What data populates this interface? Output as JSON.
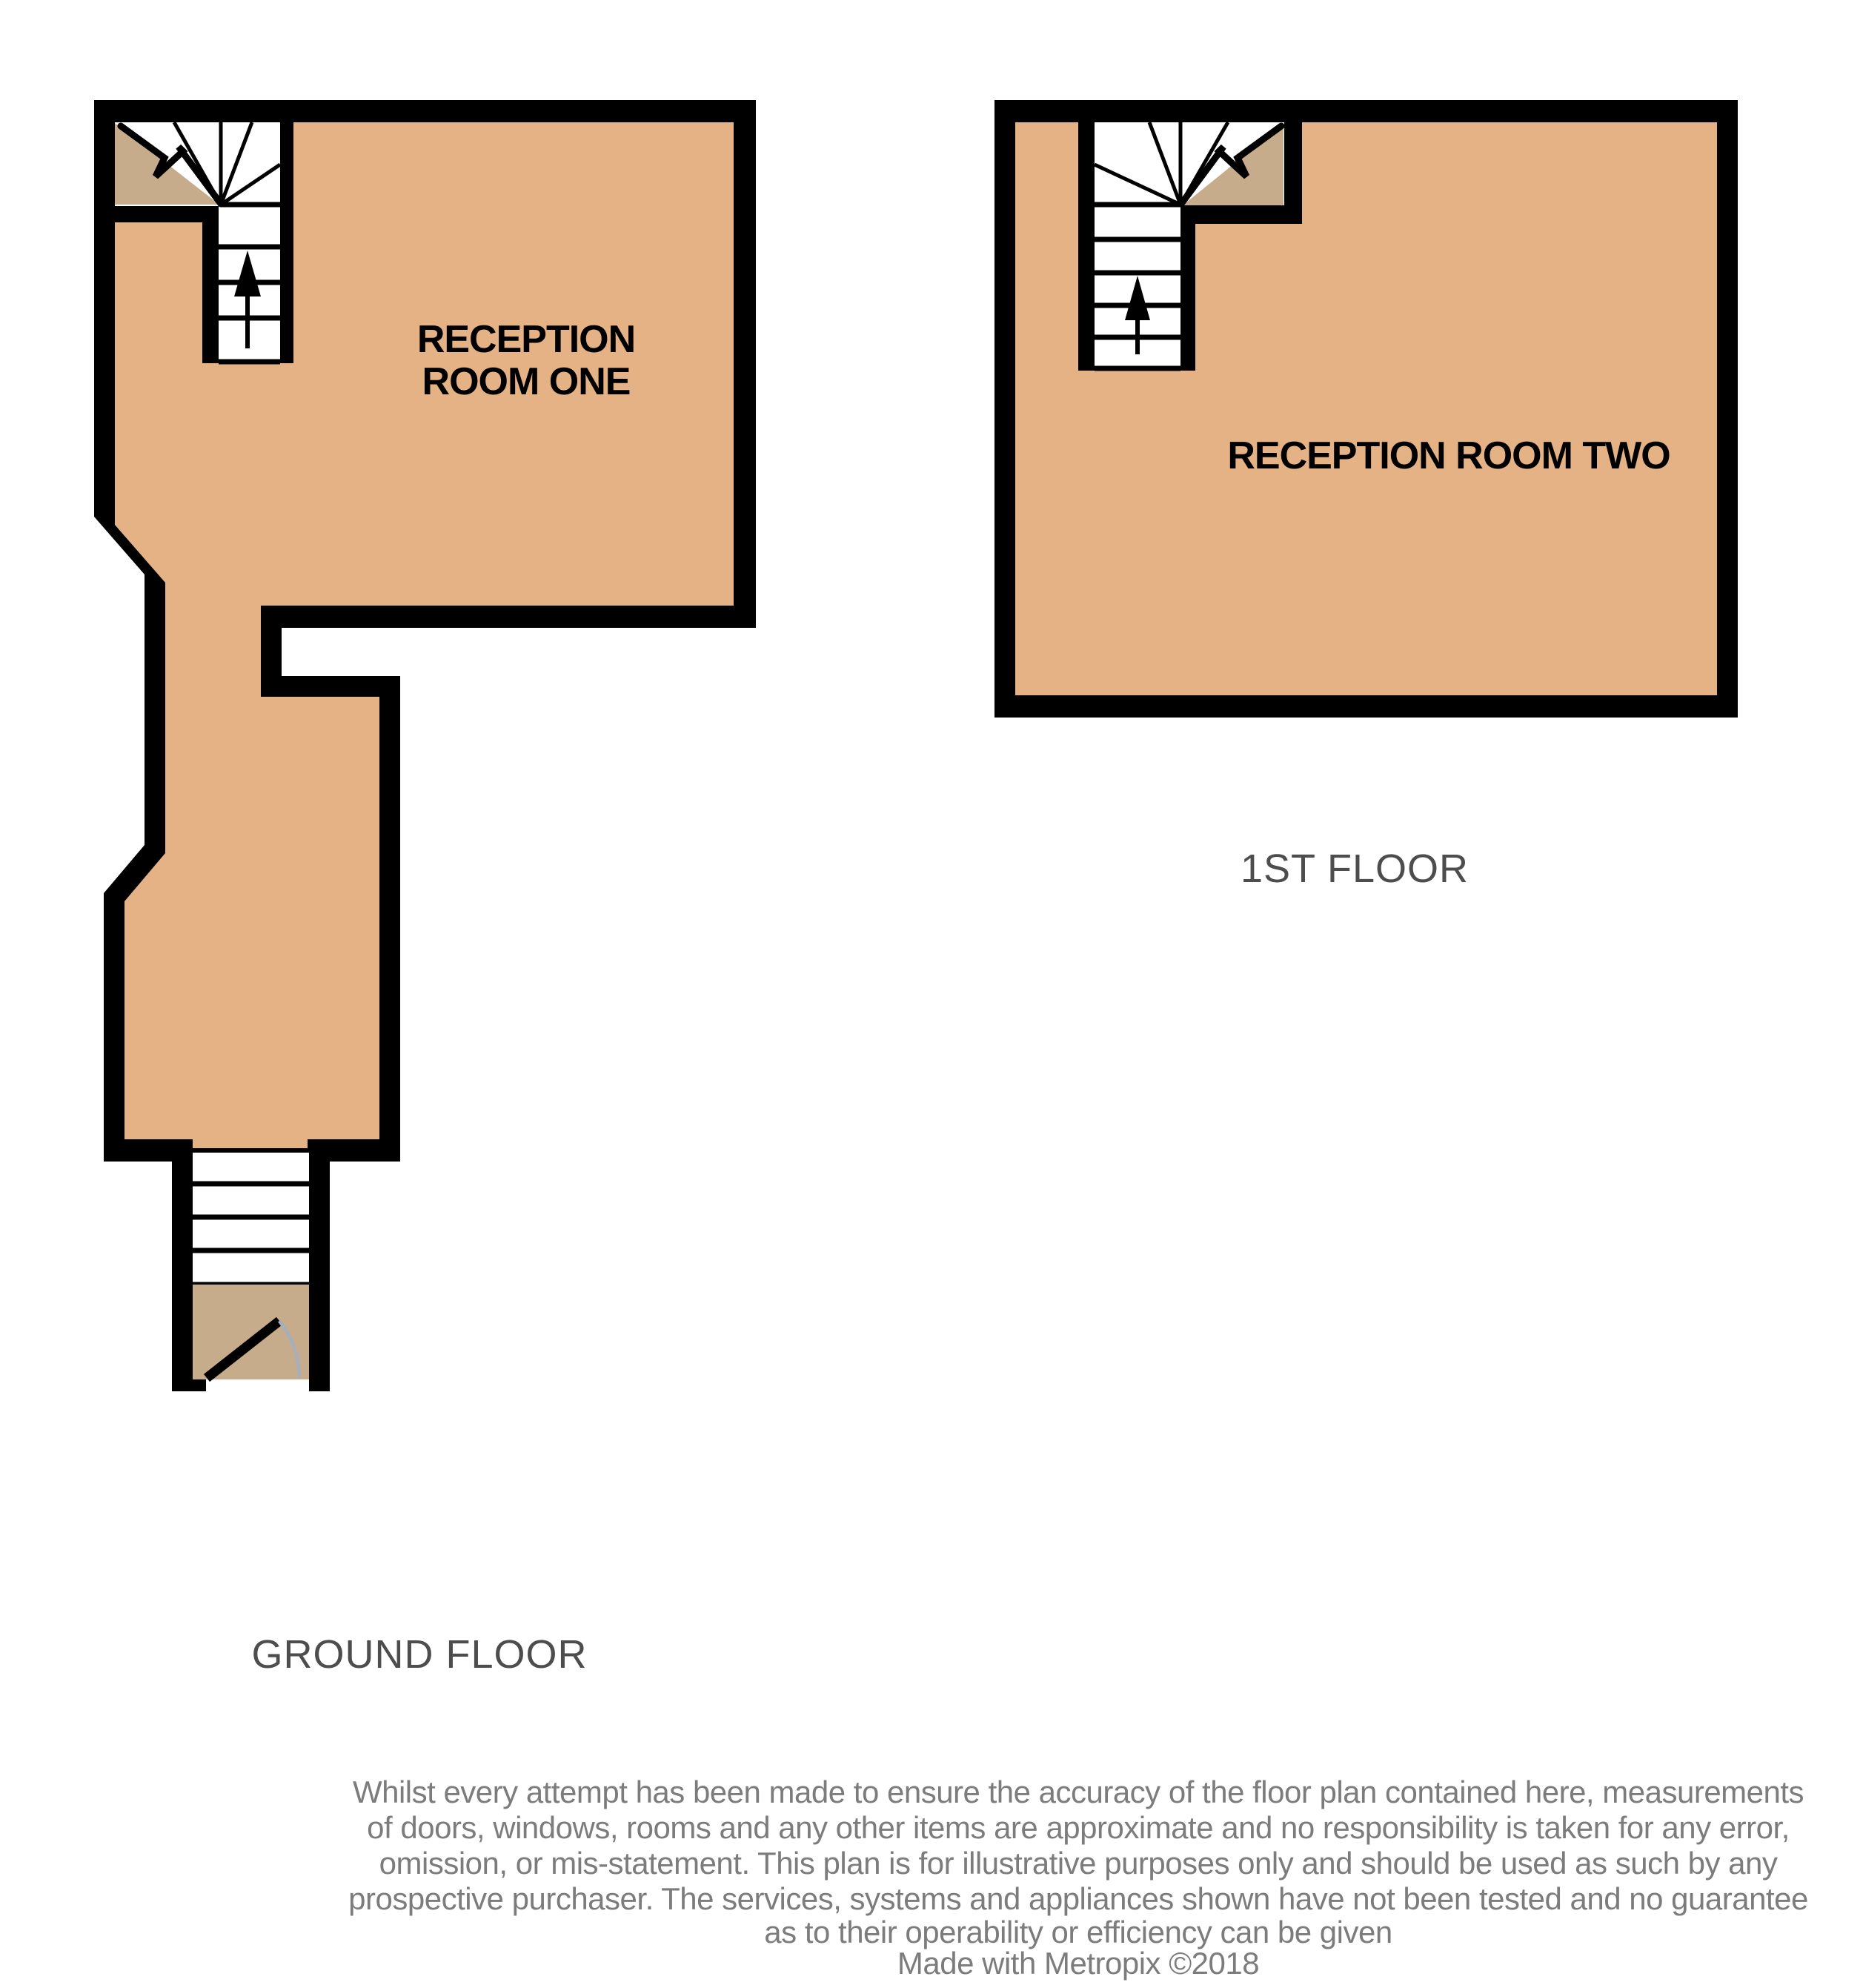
{
  "ground_floor": {
    "title": "GROUND FLOOR",
    "room": {
      "line1": "RECEPTION",
      "line2": "ROOM ONE"
    }
  },
  "first_floor": {
    "title": "1ST FLOOR",
    "room": {
      "label": "RECEPTION ROOM TWO"
    }
  },
  "disclaimer": {
    "lines": [
      "Whilst every attempt has been made to ensure the accuracy of the floor plan contained here, measurements",
      "of doors, windows, rooms and any other items are approximate and no responsibility is taken for any error,",
      "omission, or mis-statement. This plan is for illustrative purposes only and should be used as such by any",
      "prospective purchaser. The services, systems and appliances shown have not been tested and no guarantee",
      "as to their operability or efficiency can be given"
    ]
  },
  "credit": "Made with Metropix ©2018",
  "colors": {
    "floor_fill": "#E5B285",
    "landing_fill": "#C7AC8B",
    "wall": "#000000",
    "door_arc": "#A9AFB9",
    "floor_label": "#4D4D4D",
    "disclaimer_text": "#7C7C7C",
    "room_label": "#000000"
  }
}
